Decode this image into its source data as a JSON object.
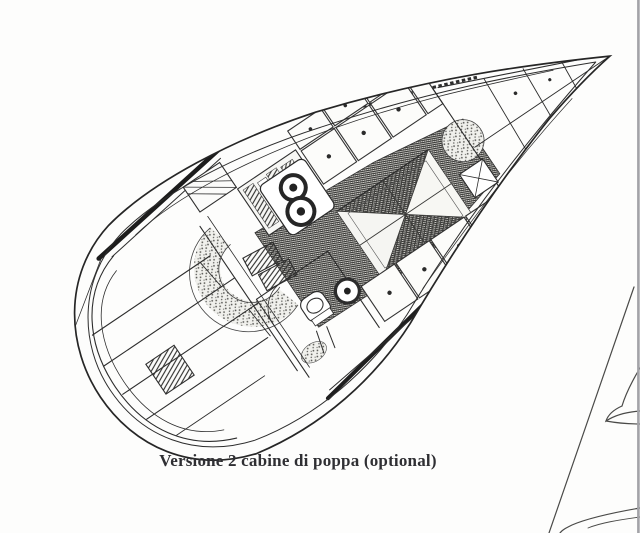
{
  "figure": {
    "caption": "Versione 2 cabine di poppa (optional)",
    "subject": "sailing-yacht-interior-deck-plan",
    "ink_color": "#2d2d2d",
    "paper_color": "#fdfdfc",
    "page_edge_color": "#a3a3a8"
  }
}
